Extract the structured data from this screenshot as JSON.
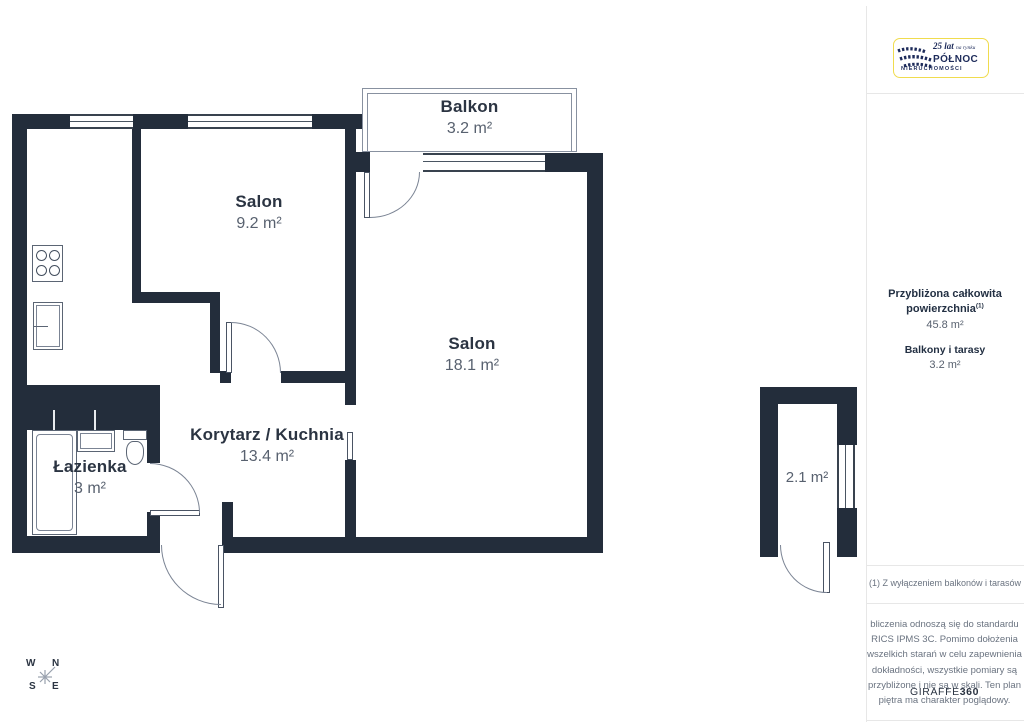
{
  "branding": {
    "logo_years": "25 lat",
    "logo_years_small": "na rynku",
    "logo_name": "PÓŁNOC",
    "logo_sub": "NIERUCHOMOŚCI"
  },
  "sidebar": {
    "total_area_label": "Przybliżona całkowita powierzchnia",
    "total_area_sup": "(1)",
    "total_area_value": "45.8 m²",
    "balconies_label": "Balkony i tarasy",
    "balconies_value": "3.2 m²",
    "footnote": "(1) Z wyłączeniem balkonów i tarasów",
    "disclaimer": "bliczenia odnoszą się do standardu RICS IPMS 3C. Pomimo dołożenia wszelkich starań w celu zapewnienia dokładności, wszystkie pomiary są przybliżone i nie są w skali. Ten plan piętra ma charakter poglądowy.",
    "brand_giraffe": "GIRAFFE",
    "brand_360": "360"
  },
  "rooms": [
    {
      "id": "balkon",
      "name": "Balkon",
      "area": "3.2 m²"
    },
    {
      "id": "salon-maly",
      "name": "Salon",
      "area": "9.2 m²"
    },
    {
      "id": "salon-duzy",
      "name": "Salon",
      "area": "18.1 m²"
    },
    {
      "id": "korytarz-kuchnia",
      "name": "Korytarz / Kuchnia",
      "area": "13.4 m²"
    },
    {
      "id": "lazienka",
      "name": "Łazienka",
      "area": "3 m²"
    },
    {
      "id": "loggia",
      "name": "",
      "area": "2.1 m²"
    }
  ],
  "compass": {
    "n": "N",
    "s": "S",
    "e": "E",
    "w": "W"
  },
  "colors": {
    "wall": "#232d3b",
    "label": "#2b3442",
    "area_text": "#58616f",
    "logo_yellow": "#f0dc4e",
    "logo_navy": "#1d2b5a"
  }
}
